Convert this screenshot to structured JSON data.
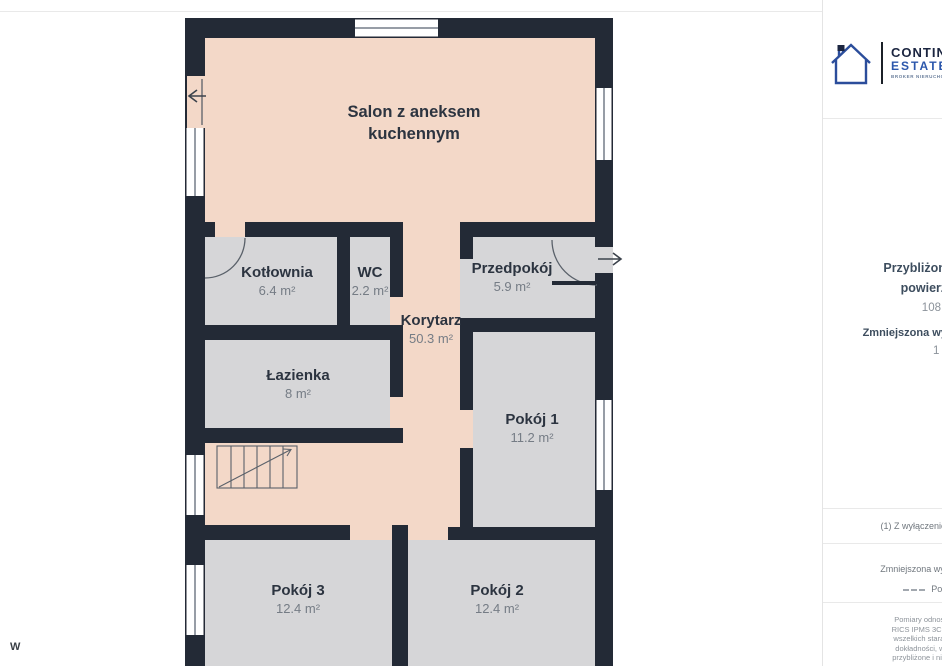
{
  "page": {
    "watermark": "W"
  },
  "plan": {
    "colors": {
      "wall": "#232a36",
      "room_fill": "#d6d6d8",
      "living_fill": "#f3d8c8"
    },
    "rooms": [
      {
        "name": "Salon z aneksem kuchennym",
        "area": ""
      },
      {
        "name": "Kotłownia",
        "area": "6.4 m²"
      },
      {
        "name": "WC",
        "area": "2.2 m²"
      },
      {
        "name": "Przedpokój",
        "area": "5.9 m²"
      },
      {
        "name": "Korytarz",
        "area": "50.3 m²"
      },
      {
        "name": "Łazienka",
        "area": "8 m²"
      },
      {
        "name": "Pokój 1",
        "area": "11.2 m²"
      },
      {
        "name": "Pokój 3",
        "area": "12.4 m²"
      },
      {
        "name": "Pokój 2",
        "area": "12.4 m²"
      }
    ]
  },
  "sidebar": {
    "brand": {
      "name_line1": "CONTINE",
      "name_line2": "ESTATES",
      "tagline": "BROKER NIERUCHOMO"
    },
    "total_label_line1": "Przybliżona całkowit",
    "total_label_line2": "powierzchnia",
    "total_sup": "(1)",
    "total_value": "108.8 m²",
    "reduced_label": "Zmniejszona wysokość pomies",
    "reduced_value": "1 m²",
    "footnote": "(1) Z wyłączeniem balkonów i ta",
    "legend_label": "Zmniejszona wysokość pomiesz",
    "legend_value": "Poniżej 1.5 m",
    "disclaimer_lines": [
      "Pomiary odnoszą się do stand",
      "RICS IPMS 3C. Pomimo dołoże",
      "wszelkich starań w celu zapew",
      "dokładności, wszystkie pomia",
      "przybliżone i nie są w skali. Ten"
    ]
  }
}
